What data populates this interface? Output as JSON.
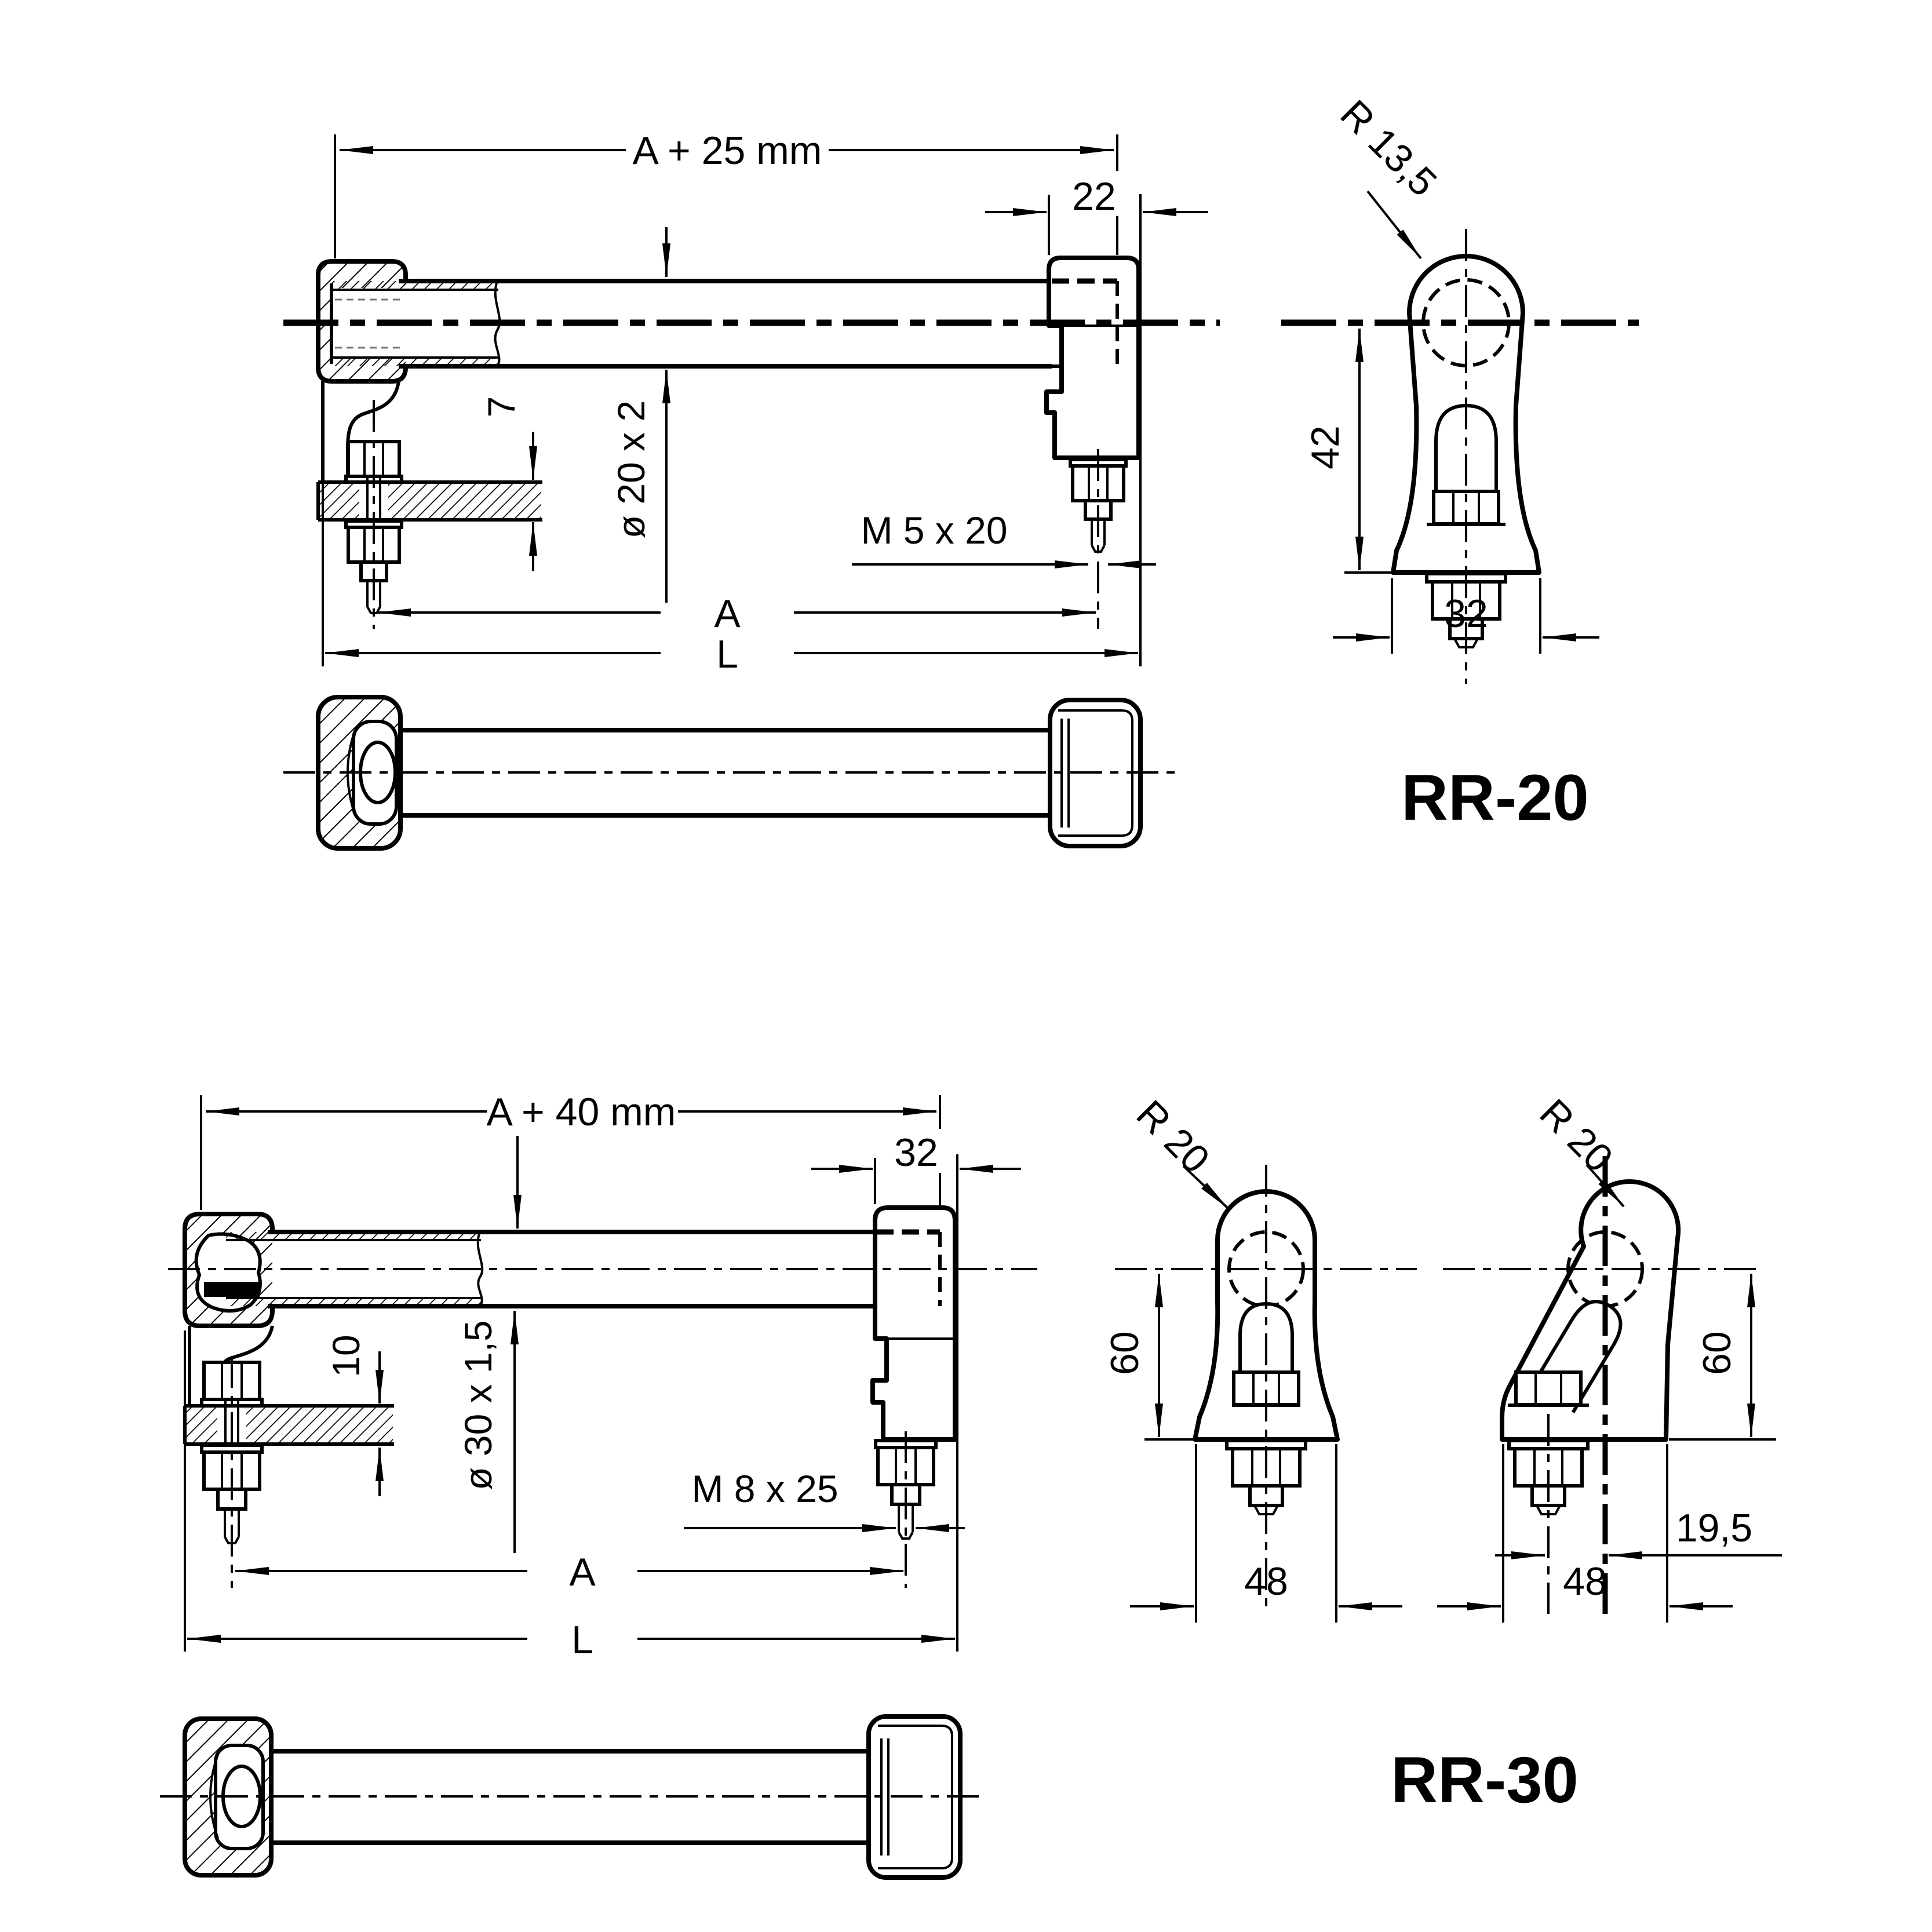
{
  "drawing": {
    "background": "#ffffff",
    "line_color": "#000000",
    "rr20": {
      "label": "RR-20",
      "dims": {
        "overall_top": "A + 25 mm",
        "foot_width": "22",
        "panel_thickness": "7",
        "tube": "ø 20 x 2",
        "screw": "M 5 x 20",
        "hole_spacing": "A",
        "length": "L",
        "radius": "R 13,5",
        "height": "42",
        "foot_depth": "32"
      }
    },
    "rr30": {
      "label": "RR-30",
      "dims": {
        "overall_top": "A + 40 mm",
        "foot_width": "32",
        "panel_thickness": "10",
        "tube": "ø 30 x 1,5",
        "screw": "M 8 x 25",
        "hole_spacing": "A",
        "length": "L",
        "radius_straight": "R 20",
        "radius_tilted": "R 20",
        "height_straight": "60",
        "height_tilted": "60",
        "foot_depth_straight": "48",
        "foot_depth_tilted": "48",
        "offset": "19,5"
      }
    }
  }
}
